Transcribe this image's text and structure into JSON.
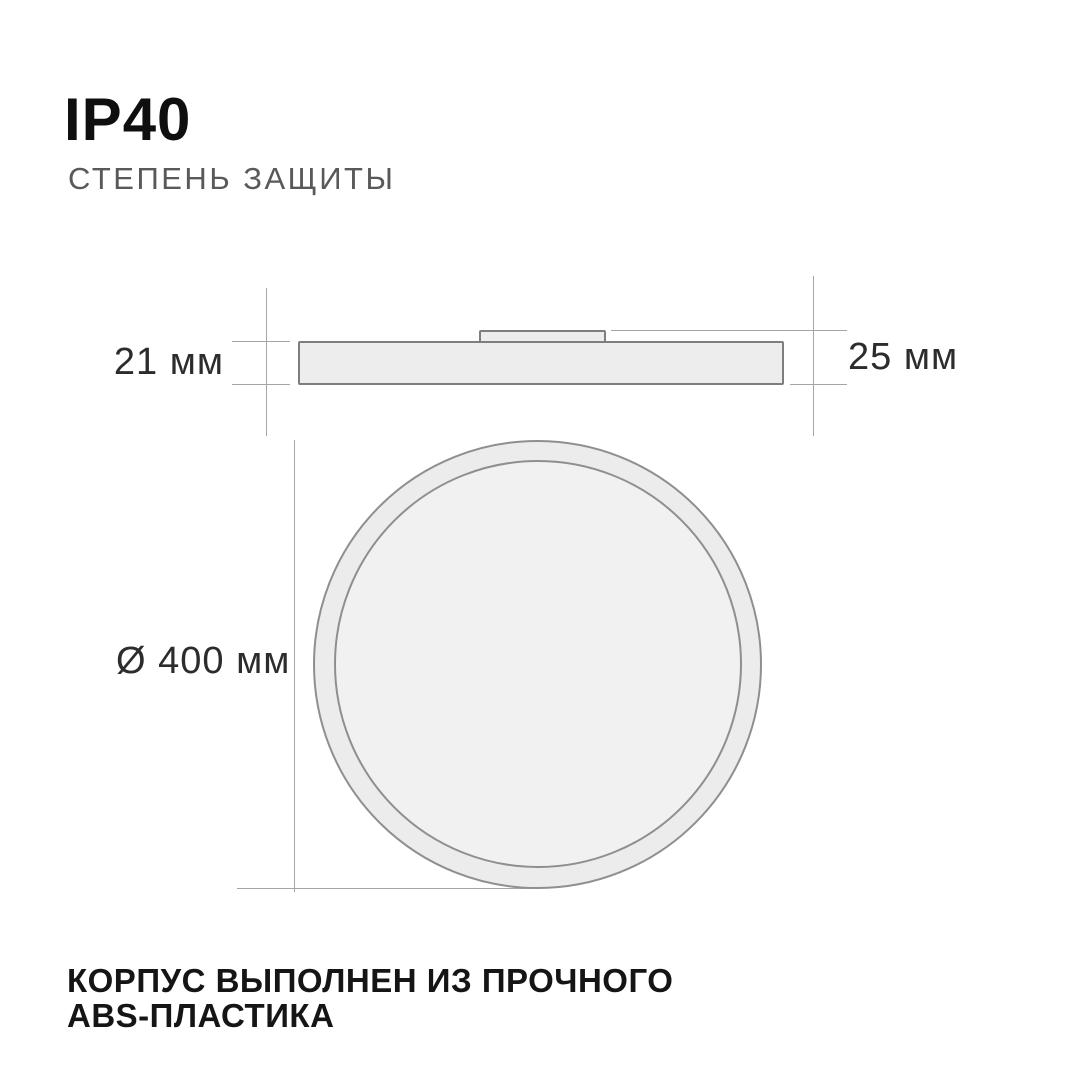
{
  "header": {
    "title": "IP40",
    "subtitle": "СТЕПЕНЬ ЗАЩИТЫ"
  },
  "side_view": {
    "label_body_height": "21 мм",
    "label_total_height": "25 мм"
  },
  "front_view": {
    "label_diameter": "Ø 400 мм"
  },
  "footer": {
    "line1": "КОРПУС ВЫПОЛНЕН ИЗ ПРОЧНОГО",
    "line2": "ABS-ПЛАСТИКА"
  },
  "colors": {
    "background": "#ffffff",
    "title_text": "#0f0f0f",
    "subtitle_text": "#59595b",
    "dimension_text": "#2c2c2c",
    "dimension_line": "#a6a6a6",
    "shape_border": "#7e7e7e",
    "shape_fill": "#ededed",
    "circle_border": "#8f8f8f",
    "ring_fill": "#ececec",
    "inner_circle_fill": "#f1f1f1",
    "footer_text": "#151515"
  }
}
